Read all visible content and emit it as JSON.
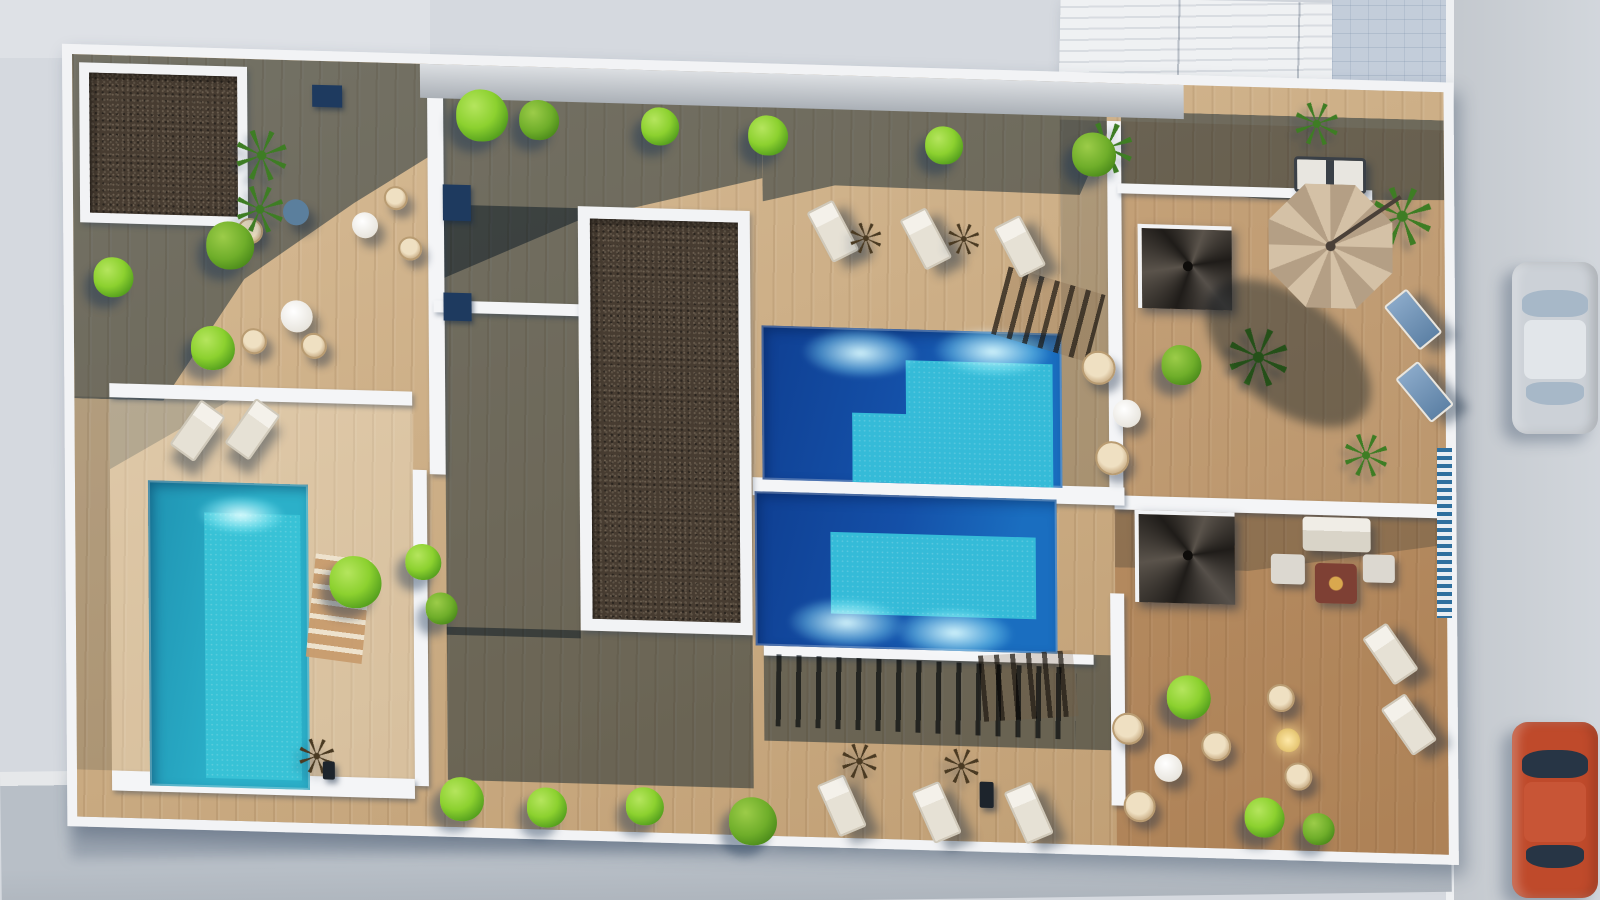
{
  "meta": {
    "type": "architectural-aerial-render",
    "description": "Top-down 3D rendering of a residential rooftop terrace complex with three swimming pools, wood decking, gravel planter roofs, lounge furniture, umbrella, spiral staircases, surrounding pavement, road and two parked cars",
    "no_visible_text": true
  },
  "palette": {
    "pavement": "#d5d9df",
    "road": "#ced3d9",
    "curb": "#eef0f2",
    "sidewalk": "#b8bfc7",
    "paving_blue": "#c3cdda",
    "roof_rib_light": "#eff1f3",
    "roof_rib_dark": "#d8dce1",
    "site_white": "#f2f3f5",
    "wood": "#c9a87d",
    "wood_warm": "#b5763f",
    "shadow_slate": "rgba(28,62,96,0.52)",
    "gravel": "#473c31",
    "pool_deep": "#1450a8",
    "pool_light": "#35bbd8",
    "pool_left": "#2bb0c9",
    "green_bright": "#8cd12f",
    "green_dark": "#6fae2a",
    "wicker_tan": "#d9c29e",
    "furniture_white": "#ece8e0",
    "umbrella_tan": "#cbb79c",
    "car_silver": "#ccd1d7",
    "car_red": "#bf4a2b",
    "navy_box": "#1e3a5f",
    "stair_dark": "#2a2724"
  },
  "surroundings": {
    "top_strip": {
      "x": 0,
      "y": 0,
      "w": 430,
      "h": 58
    },
    "building_ne": {
      "x": 1058,
      "y": 0,
      "w": 276,
      "h": 248,
      "rot": 1.2
    },
    "paving_ne": {
      "x": 1332,
      "y": 0,
      "w": 122,
      "h": 762
    },
    "road_e": {
      "x": 1452,
      "y": 0,
      "w": 148,
      "h": 900
    },
    "curb_e": {
      "x": 1446,
      "y": 0,
      "w": 8,
      "h": 900
    },
    "sidewalk_s": {
      "x": 0,
      "y": 772,
      "w": 1450,
      "h": 140,
      "rot": -0.8
    },
    "site_cast_shadow": {
      "x": 70,
      "y": 780,
      "w": 660,
      "h": 74,
      "rot": -0.8
    },
    "pillar": {
      "x": 778,
      "y": 792,
      "w": 56,
      "h": 50
    },
    "fence_blue": {
      "x": 1437,
      "y": 448,
      "w": 15,
      "h": 170
    },
    "cars": [
      {
        "kind": "silver",
        "x": 1512,
        "y": 262,
        "w": 86,
        "h": 172
      },
      {
        "kind": "red",
        "x": 1512,
        "y": 722,
        "w": 86,
        "h": 176
      }
    ]
  },
  "site": {
    "x": 62,
    "y": 44,
    "w": 1372,
    "h": 762,
    "rot": 1.6,
    "skew": 2,
    "cap": {
      "x": 348,
      "y": 0,
      "w": 764,
      "h": 34
    },
    "planters": [
      {
        "x": 7,
        "y": 8,
        "w": 168,
        "h": 160,
        "frame": 10
      },
      {
        "x": 505,
        "y": 138,
        "w": 172,
        "h": 424,
        "frame": 12
      }
    ],
    "pools": [
      {
        "id": "upper",
        "x": 688,
        "y": 252,
        "w": 300,
        "h": 154,
        "light": "30% 100%,30% 55%,48% 55%,48% 20%,97% 20%,97% 100%",
        "caustics": [
          [
            33,
            16
          ],
          [
            77,
            13
          ]
        ]
      },
      {
        "id": "lower",
        "x": 680,
        "y": 418,
        "w": 302,
        "h": 154,
        "light": "25% 25%,93% 25%,93% 78%,25% 78%",
        "caustics": [
          [
            30,
            84
          ],
          [
            66,
            88
          ]
        ]
      },
      {
        "id": "left",
        "x": 73,
        "y": 424,
        "w": 160,
        "h": 305,
        "light": "35% 10%,95% 10%,95% 97%,35% 97%",
        "caustics": []
      }
    ],
    "walkway": {
      "x": 678,
      "y": 404,
      "w": 372,
      "h": 18
    },
    "walls": [
      [
        355,
        12,
        16,
        398
      ],
      [
        338,
        406,
        14,
        316
      ],
      [
        360,
        236,
        26,
        12
      ],
      [
        398,
        236,
        120,
        12
      ],
      [
        35,
        328,
        303,
        14
      ],
      [
        35,
        715,
        303,
        20
      ],
      [
        1035,
        38,
        14,
        380
      ],
      [
        1035,
        510,
        14,
        212
      ],
      [
        1040,
        412,
        332,
        14
      ],
      [
        688,
        572,
        330,
        10
      ],
      [
        1045,
        100,
        255,
        10
      ]
    ],
    "navy_boxes": [
      [
        240,
        24,
        30,
        22
      ],
      [
        370,
        120,
        28,
        36
      ],
      [
        370,
        228,
        28,
        28
      ]
    ],
    "shadows": [
      {
        "x": 0,
        "y": 0,
        "w": 356,
        "h": 344,
        "clip": "0% 0%,100% 0%,100% 27%,79% 41%,48% 64%,25% 100%,0% 100%"
      },
      {
        "x": 356,
        "y": 0,
        "w": 334,
        "h": 214,
        "clip": "0% 0%,100% 0%,100% 49%,45% 71%,4% 100%,0% 100%"
      },
      {
        "x": 371,
        "y": 140,
        "w": 134,
        "h": 430
      },
      {
        "x": 371,
        "y": 562,
        "w": 306,
        "h": 153
      },
      {
        "x": 690,
        "y": 0,
        "w": 345,
        "h": 128,
        "clip": "0% 0%,100% 0%,100% 39%,92% 88%,21% 86%,0% 100%"
      },
      {
        "x": 1049,
        "y": 28,
        "w": 323,
        "h": 84,
        "clip": "0% 0%,100% 0%,100% 95%,46% 100%,0% 88%"
      },
      {
        "x": 988,
        "y": 38,
        "w": 47,
        "h": 380,
        "o": 0.35
      },
      {
        "x": 1040,
        "y": 426,
        "w": 332,
        "h": 58,
        "o": 0.45,
        "clip": "0% 0%,100% 0%,100% 45%,40% 100%,0% 100%"
      },
      {
        "x": 35,
        "y": 342,
        "w": 120,
        "h": 72,
        "o": 0.4,
        "clip": "0% 0%,100% 0%,0% 100%"
      },
      {
        "x": 0,
        "y": 342,
        "w": 35,
        "h": 373,
        "o": 0.3
      },
      {
        "x": 688,
        "y": 572,
        "w": 350,
        "h": 95
      }
    ],
    "tints": [
      {
        "x": 1049,
        "y": 38,
        "w": 323,
        "h": 374,
        "color": "#b5763f",
        "o": 0.16
      },
      {
        "x": 1040,
        "y": 426,
        "w": 332,
        "h": 336,
        "color": "#b5763f",
        "o": 0.33
      },
      {
        "x": 35,
        "y": 342,
        "w": 303,
        "h": 373,
        "color": "#ecdcc0",
        "o": 0.32
      }
    ],
    "stairs": [
      {
        "x": 925,
        "y": 198,
        "w": 100,
        "h": 70,
        "rot": 15,
        "kind": "rail"
      },
      {
        "x": 905,
        "y": 572,
        "w": 95,
        "h": 66,
        "rot": -5,
        "kind": "rail"
      },
      {
        "x": 700,
        "y": 583,
        "w": 300,
        "h": 72,
        "rot": 1,
        "kind": "slats"
      },
      {
        "x": 235,
        "y": 495,
        "w": 56,
        "h": 104,
        "rot": 6,
        "kind": "steps"
      }
    ],
    "spiral_stairs": [
      [
        1065,
        140,
        90,
        80
      ],
      [
        1060,
        426,
        96,
        88
      ]
    ],
    "umbrella": {
      "cx": 1258,
      "cy": 157,
      "r": 62,
      "shadow": {
        "x": 1120,
        "y": 210,
        "w": 190,
        "h": 110,
        "rot": 38
      }
    },
    "furniture": {
      "sofa_top": {
        "x": 1222,
        "y": 68,
        "w": 72,
        "h": 36
      },
      "sofa_lounge": {
        "x": 1228,
        "y": 428,
        "w": 68,
        "h": 34
      },
      "fire_table": {
        "x": 1240,
        "y": 474,
        "w": 42,
        "h": 40
      },
      "ottomans": [
        [
          1196,
          466,
          34,
          30
        ],
        [
          1288,
          464,
          32,
          28
        ]
      ]
    },
    "tables": [
      {
        "x": 223,
        "y": 152,
        "r": 13,
        "kind": "shade"
      },
      {
        "x": 292,
        "y": 163,
        "r": 13,
        "kind": "white"
      },
      {
        "x": 223,
        "y": 256,
        "r": 16,
        "kind": "white"
      },
      {
        "x": 1053,
        "y": 330,
        "r": 14,
        "kind": "white"
      },
      {
        "x": 1092,
        "y": 683,
        "r": 14,
        "kind": "white"
      },
      {
        "x": 1212,
        "y": 652,
        "r": 12,
        "kind": "glow"
      }
    ],
    "chairs": [
      [
        177,
        172,
        13
      ],
      [
        180,
        282,
        13
      ],
      [
        240,
        285,
        13
      ],
      [
        323,
        135,
        12
      ],
      [
        337,
        185,
        12
      ],
      [
        1025,
        285,
        17
      ],
      [
        1038,
        375,
        17
      ],
      [
        1052,
        645,
        16
      ],
      [
        1063,
        722,
        16
      ],
      [
        1205,
        610,
        14
      ],
      [
        1222,
        688,
        14
      ],
      [
        1140,
        660,
        15
      ]
    ],
    "loungers": [
      {
        "x": 745,
        "y": 128,
        "rot": -28,
        "kind": "white"
      },
      {
        "x": 838,
        "y": 133,
        "rot": -28,
        "kind": "white"
      },
      {
        "x": 932,
        "y": 138,
        "rot": -28,
        "kind": "white"
      },
      {
        "x": 750,
        "y": 702,
        "rot": -24,
        "kind": "white"
      },
      {
        "x": 845,
        "y": 706,
        "rot": -24,
        "kind": "white"
      },
      {
        "x": 937,
        "y": 704,
        "rot": -24,
        "kind": "white"
      },
      {
        "x": 108,
        "y": 345,
        "rot": 35,
        "kind": "white"
      },
      {
        "x": 163,
        "y": 342,
        "rot": 35,
        "kind": "white"
      },
      {
        "x": 1325,
        "y": 200,
        "rot": -40,
        "kind": "blue"
      },
      {
        "x": 1336,
        "y": 272,
        "rot": -40,
        "kind": "blue"
      },
      {
        "x": 1300,
        "y": 535,
        "rot": -35,
        "kind": "white"
      },
      {
        "x": 1318,
        "y": 605,
        "rot": -35,
        "kind": "white"
      }
    ],
    "palms": [
      {
        "x": 189,
        "y": 96,
        "s": 52,
        "kind": "green"
      },
      {
        "x": 187,
        "y": 150,
        "s": 48,
        "kind": "green"
      },
      {
        "x": 1035,
        "y": 65,
        "s": 52,
        "kind": "green"
      },
      {
        "x": 1185,
        "y": 270,
        "s": 60,
        "kind": "green"
      },
      {
        "x": 1330,
        "y": 125,
        "s": 60,
        "kind": "green"
      },
      {
        "x": 1292,
        "y": 365,
        "s": 44,
        "kind": "green"
      },
      {
        "x": 1245,
        "y": 35,
        "s": 44,
        "kind": "green"
      },
      {
        "x": 793,
        "y": 162,
        "s": 32,
        "kind": "dark"
      },
      {
        "x": 891,
        "y": 160,
        "s": 32,
        "kind": "dark"
      },
      {
        "x": 783,
        "y": 685,
        "s": 36,
        "kind": "dark"
      },
      {
        "x": 885,
        "y": 687,
        "s": 36,
        "kind": "dark"
      },
      {
        "x": 240,
        "y": 695,
        "s": 36,
        "kind": "dark"
      }
    ],
    "bushes": [
      [
        40,
        222,
        20,
        "b"
      ],
      [
        157,
        187,
        24,
        "d"
      ],
      [
        139,
        290,
        22,
        "b"
      ],
      [
        410,
        50,
        26,
        "b"
      ],
      [
        467,
        53,
        20,
        "d"
      ],
      [
        588,
        56,
        19,
        "b"
      ],
      [
        696,
        62,
        20,
        "b"
      ],
      [
        872,
        67,
        19,
        "b"
      ],
      [
        1022,
        72,
        22,
        "d"
      ],
      [
        280,
        520,
        26,
        "b"
      ],
      [
        348,
        498,
        18,
        "b"
      ],
      [
        366,
        544,
        16,
        "d"
      ],
      [
        385,
        734,
        22,
        "b"
      ],
      [
        470,
        740,
        20,
        "b"
      ],
      [
        568,
        736,
        19,
        "b"
      ],
      [
        676,
        748,
        24,
        "d"
      ],
      [
        1108,
        280,
        20,
        "d"
      ],
      [
        1113,
        612,
        22,
        "b"
      ],
      [
        1188,
        730,
        20,
        "b"
      ],
      [
        1242,
        740,
        16,
        "d"
      ]
    ],
    "dark_bits": [
      [
        903,
        702,
        14,
        26
      ],
      [
        246,
        700,
        12,
        18
      ]
    ]
  }
}
